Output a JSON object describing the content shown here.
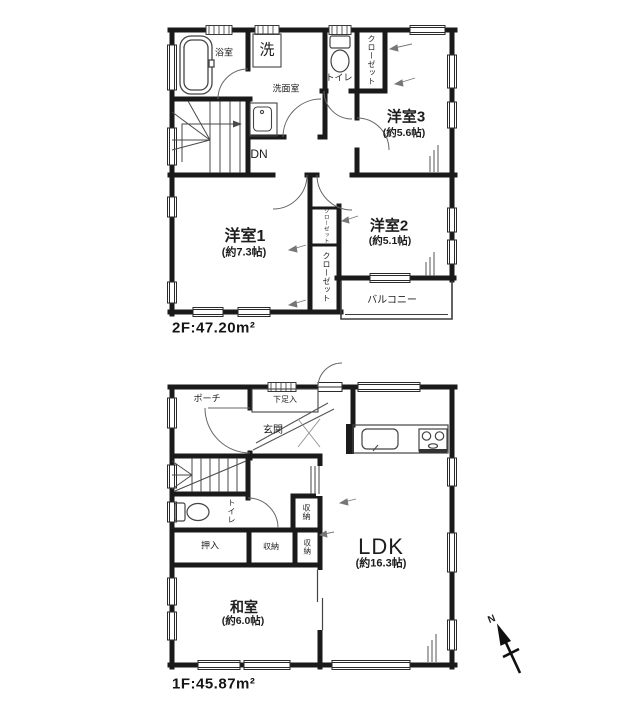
{
  "floor2": {
    "area_label": "2F:47.20m²",
    "rooms": {
      "bath": "浴室",
      "laundry": "洗",
      "washroom": "洗面室",
      "toilet": "トイレ",
      "closet_hall": "クローゼット",
      "room3": "洋室3",
      "room3_size": "(約5.6帖)",
      "stairs_dn": "DN",
      "room1": "洋室1",
      "room1_size": "(約7.3帖)",
      "room2": "洋室2",
      "room2_size": "(約5.1帖)",
      "closet_small": "クローゼット",
      "closet_tall": "クローゼット",
      "balcony": "バルコニー"
    }
  },
  "floor1": {
    "area_label": "1F:45.87m²",
    "rooms": {
      "porch": "ポーチ",
      "shoe_cabinet": "下足入",
      "entrance": "玄関",
      "toilet": "トイレ",
      "storage_hall": "収納",
      "storage_mid": "収納",
      "storage_narrow": "収納",
      "oshiire": "押入",
      "washitsu": "和室",
      "washitsu_size": "(約6.0帖)",
      "ldk": "LDK",
      "ldk_size": "(約16.3帖)"
    }
  },
  "compass": {
    "north": "N"
  }
}
